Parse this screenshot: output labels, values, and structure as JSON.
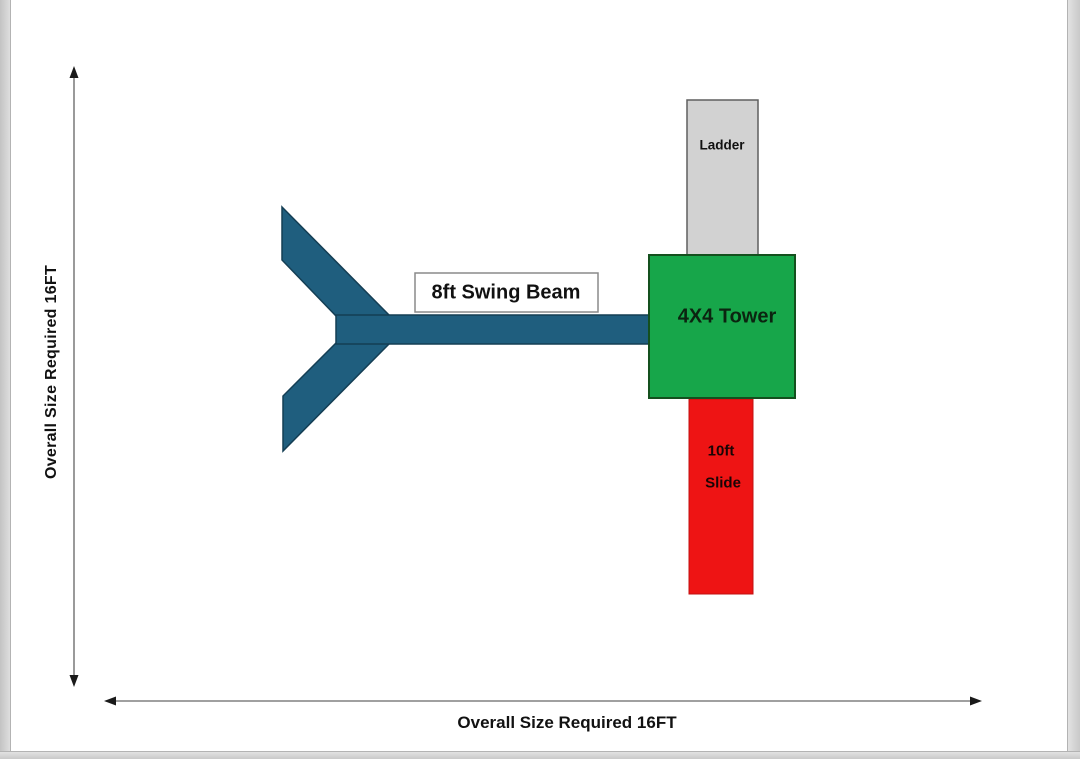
{
  "canvas": {
    "background": "#ffffff",
    "frame_color": "#d4d4d4",
    "arrow_line_color": "#808080",
    "arrowhead_color": "#1a1a1a"
  },
  "dimensions": {
    "vertical": {
      "label": "Overall Size Required 16FT"
    },
    "horizontal": {
      "label": "Overall Size Required 16FT"
    }
  },
  "components": {
    "swing_beam": {
      "label": "8ft Swing Beam",
      "color": "#1f5e7e",
      "border_color": "#143e54"
    },
    "tower": {
      "label": "4X4 Tower",
      "color": "#17a64a",
      "border_color": "#14501e"
    },
    "ladder": {
      "label": "Ladder",
      "color": "#d2d2d2",
      "border_color": "#5f5f5f"
    },
    "slide": {
      "label_line1": "10ft",
      "label_line2": "Slide",
      "color": "#ee1414",
      "border_color": "#c21010"
    },
    "label_box": {
      "fill": "#ffffff",
      "border_color": "#8a8a8a"
    }
  }
}
